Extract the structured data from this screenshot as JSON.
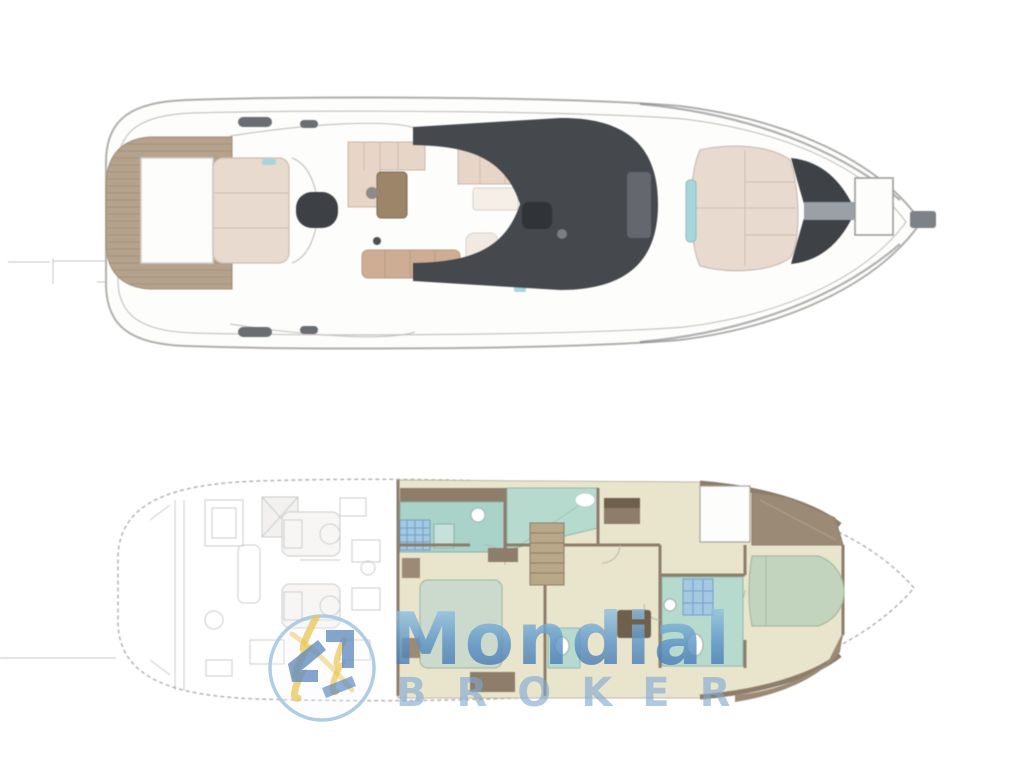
{
  "page": {
    "background": "#ffffff"
  },
  "watermark": {
    "brand_name": "Mondial",
    "brand_suffix": "BROKER",
    "emblem_icon": "mondial-broker-circle-emblem",
    "colors": {
      "gradient_top": "#a6d4e8",
      "gradient_mid": "#5a92c6",
      "gradient_bottom": "#3f6ba6",
      "broker_blue": "#7fa9d2",
      "ring_blue": "#a9c8e2",
      "mark_blue": "#5f8bbf",
      "mark_gold": "#e8c653"
    }
  },
  "diagram": {
    "type": "yacht-deck-plan-diagram",
    "palette": {
      "hull_line": "#b2afab",
      "hull_inner_line": "#c9c6c1",
      "deck_white": "#fdfdfc",
      "teak": "#b5a28c",
      "teak_line": "#a18f78",
      "sunpad": "#e9dacf",
      "sunpad_line": "#cdbdb2",
      "cushion": "#e7d5c8",
      "cushion_line": "#cbb7a9",
      "cushion_tan": "#cead94",
      "table_wood": "#9c8568",
      "hardtop_dark": "#45484d",
      "seat_dark": "#303438",
      "console_gray": "#64686e",
      "metal_gray": "#7d8286",
      "glass_teal": "#a7d6da",
      "floor_cream": "#e9e5cd",
      "wall_brown": "#8d7d6a",
      "wood_mid": "#9b8a75",
      "wood_dark": "#6f5f4d",
      "aqua_room": "#b7dacf",
      "aqua_counter": "#a9d2c9",
      "bed_mint": "#ccdacd",
      "bed_sage": "#c2d4bd",
      "bed_line": "#a6baa2",
      "shower_blue": "#a6c9e2",
      "shower_grid": "#6f9fc8",
      "stair_wood": "#b9a888",
      "faint_ink": "#9a9a98",
      "dim_line": "#c9c7c4"
    }
  }
}
